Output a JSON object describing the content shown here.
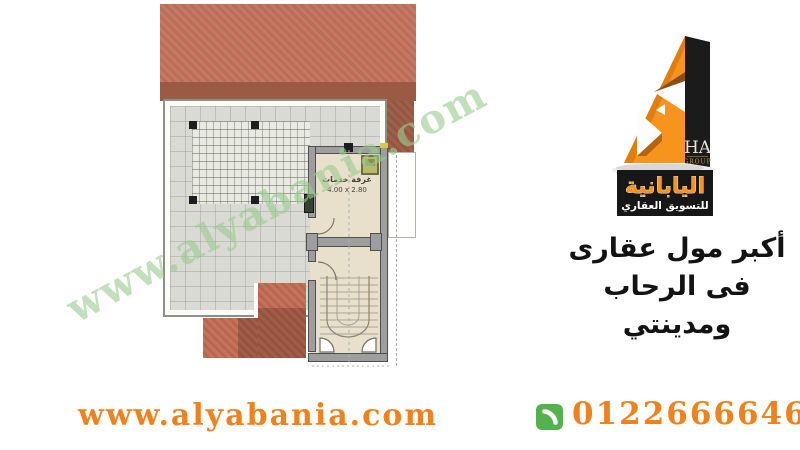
{
  "watermark": {
    "text": "www.alyabania.com"
  },
  "logo": {
    "monogram": "HA",
    "monogram_sub": "GROUP",
    "brand_name_arabic": "اليابانية",
    "brand_tagline_arabic": "للتسويق العقاري"
  },
  "headline": {
    "line1": "أكبر مول عقارى",
    "line2": "فى الرحاب ومدينتي"
  },
  "floor_plan": {
    "room_label": "غرفة خدمات",
    "room_dimensions": "4.00 x 2.80"
  },
  "footer": {
    "website": "www.alyabania.com",
    "phone": "01226666466"
  },
  "colors": {
    "accent_orange": "#f0821e",
    "logo_orange": "#f7941e",
    "phone_icon_green": "#55b14e",
    "watermark_green": "#9acb8f",
    "roof_light": "#c2715a",
    "roof_dark": "#9a5a43",
    "terrace_gray": "#d9dad3",
    "room_floor": "#e9e0cc",
    "wall_gray": "#9e9e9e"
  }
}
